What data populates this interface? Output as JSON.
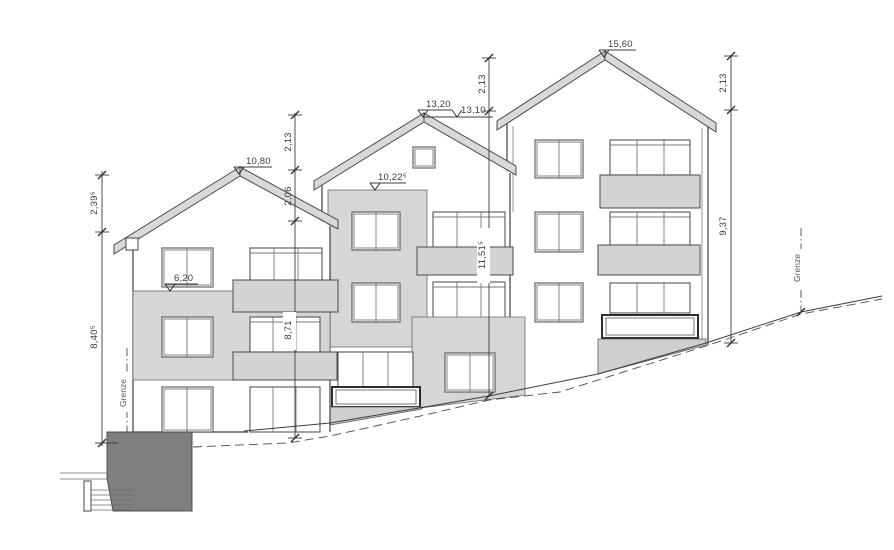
{
  "drawing": {
    "background": "#ffffff",
    "line_color": "#3c3c3c",
    "shade_color": "#d6d6d6",
    "dark_wall_color": "#7f7f7f",
    "levels": {
      "left_ridge": "10,80",
      "left_upper_floor": "6,20",
      "middle_ridge": "13,20",
      "right_eaves": "13,10",
      "middle_wall_top": "10,22⁵",
      "right_ridge": "15,60"
    },
    "dims": {
      "left_roof": "2,39⁵",
      "left_facade": "8,40⁵",
      "mid_line_top": "2,13",
      "mid_line_eave": "2,06",
      "mid_line_facade": "8,71",
      "center_line_top": "2,13",
      "center_line_facade": "11,51⁵",
      "right_line_top": "2,13",
      "right_line_facade": "9,37"
    },
    "site": {
      "boundary_left": "Grenze",
      "boundary_right": "Grenze"
    }
  }
}
